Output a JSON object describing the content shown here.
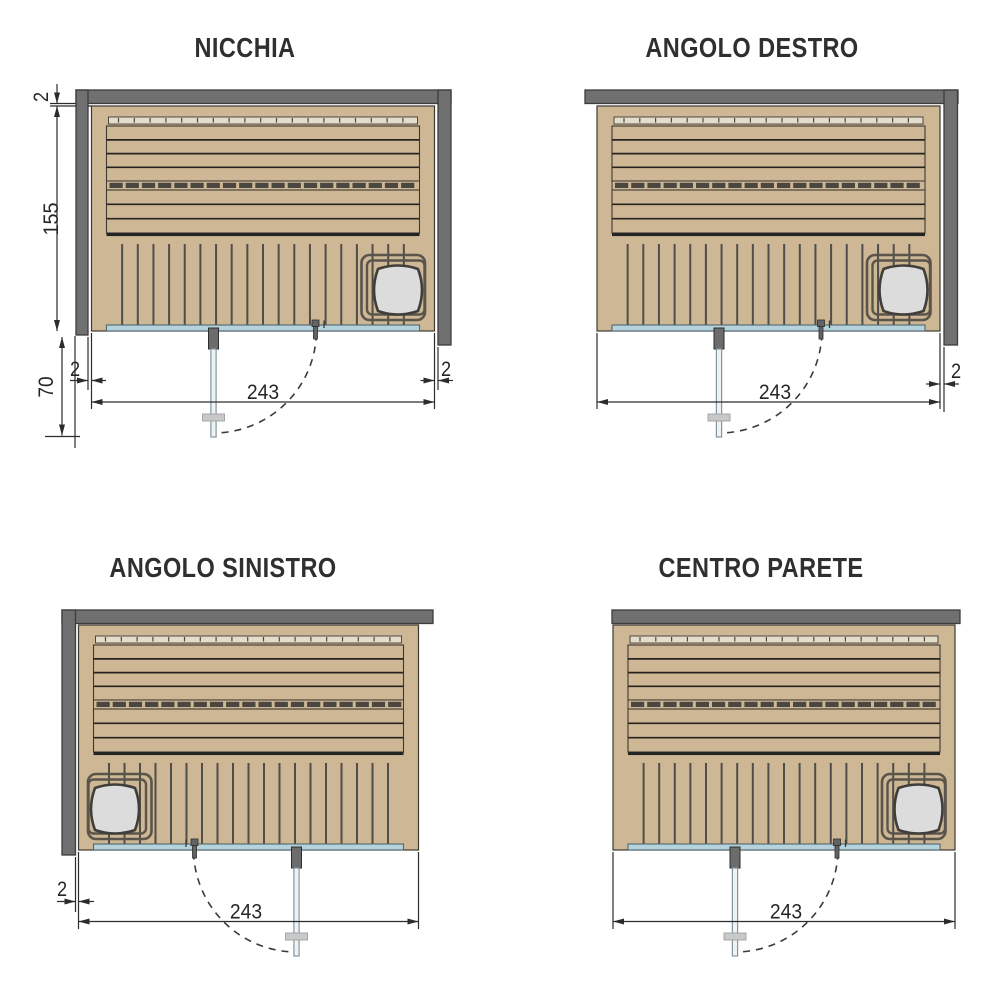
{
  "page": {
    "width": 1000,
    "height": 1000,
    "background": "#ffffff"
  },
  "colors": {
    "wood": "#cdb795",
    "wood_outline": "#3e3a32",
    "plank_gap": "#26241e",
    "backrest": "#e4ddcb",
    "segment": "#4b463f",
    "floor_gap": "#504e48",
    "glass": "#b5d3dd",
    "glass_edge": "#53666e",
    "wall": "#707070",
    "wall_edge": "#3d3d3d",
    "heater_frame": "#5a544b",
    "stove": "#dcdcdc",
    "stove_edge": "#403e3a",
    "door_glass": "#eef2f4",
    "door_edge": "#8296a0",
    "hinge": "#6c6c6c",
    "hinge_edge": "#2d2d2d",
    "handle": "#c9c9c9",
    "handle_edge": "#9f9f9f",
    "knob": "#636363",
    "dim_line": "#2c2c2c",
    "text": "#262626",
    "arc": "#3a3a3a"
  },
  "diagrams": [
    {
      "id": "nicchia",
      "title": "NICCHIA",
      "title_cx": 245,
      "title_top": 33,
      "sauna": {
        "x": 91.5,
        "y": 106,
        "w": 343,
        "h": 225,
        "heater": "right",
        "door": "left"
      },
      "walls": [
        {
          "name": "wall-top",
          "x": 76,
          "y": 90,
          "w": 375,
          "h": 13.5
        },
        {
          "name": "wall-left",
          "x": 76,
          "y": 90,
          "w": 12,
          "h": 245
        },
        {
          "name": "wall-right",
          "x": 438,
          "y": 90,
          "w": 13,
          "h": 255
        }
      ],
      "dims": [
        {
          "name": "dim-gap-top",
          "label": "2",
          "rotated": true,
          "label_pos": [
            48,
            97
          ],
          "lines": [
            [
              57,
              84,
              57,
              103.5
            ],
            [
              50,
              103.5,
              76,
              103.5
            ],
            [
              50,
              106,
              91.5,
              106
            ]
          ],
          "arrows": [
            {
              "tip": [
                57,
                103.5
              ],
              "dir": "down"
            }
          ]
        },
        {
          "name": "dim-depth",
          "label": "155",
          "rotated": true,
          "label_pos": [
            58,
            219
          ],
          "lines": [
            [
              57,
              106,
              57,
              331
            ]
          ],
          "arrows": [
            {
              "tip": [
                57,
                106
              ],
              "dir": "up"
            },
            {
              "tip": [
                57,
                331
              ],
              "dir": "down"
            }
          ]
        },
        {
          "name": "dim-clearance",
          "label": "70",
          "rotated": true,
          "label_pos": [
            53,
            387
          ],
          "lines": [
            [
              62,
              337,
              62,
              435.5
            ],
            [
              45,
              436.5,
              80,
              436.5
            ],
            [
              75,
              336,
              75,
              448
            ]
          ],
          "arrows": [
            {
              "tip": [
                62,
                337
              ],
              "dir": "up"
            },
            {
              "tip": [
                62,
                435.5
              ],
              "dir": "down"
            }
          ]
        },
        {
          "name": "dim-gap-left",
          "label": "2",
          "label_pos": [
            75,
            376
          ],
          "lines": [
            [
              88,
              337,
              88,
              390
            ],
            [
              70,
              380.5,
              88,
              380.5
            ],
            [
              91.5,
              380.5,
              106,
              380.5
            ]
          ],
          "arrows": [
            {
              "tip": [
                88,
                380.5
              ],
              "dir": "right"
            },
            {
              "tip": [
                91.5,
                380.5
              ],
              "dir": "left"
            }
          ]
        },
        {
          "name": "dim-gap-right",
          "label": "2",
          "label_pos": [
            446,
            376
          ],
          "lines": [
            [
              438,
              347,
              438,
              390
            ],
            [
              420.5,
              380.5,
              434.5,
              380.5
            ],
            [
              438,
              380.5,
              453,
              380.5
            ]
          ],
          "arrows": [
            {
              "tip": [
                434.5,
                380.5
              ],
              "dir": "right"
            },
            {
              "tip": [
                438,
                380.5
              ],
              "dir": "left"
            }
          ]
        },
        {
          "name": "dim-width",
          "label": "243",
          "label_pos": [
            263,
            399
          ],
          "lines": [
            [
              91.5,
              402,
              434.5,
              402
            ],
            [
              91.5,
              333,
              91.5,
              409
            ],
            [
              434.5,
              333,
              434.5,
              409
            ]
          ],
          "arrows": [
            {
              "tip": [
                91.5,
                402
              ],
              "dir": "left"
            },
            {
              "tip": [
                434.5,
                402
              ],
              "dir": "right"
            }
          ]
        }
      ]
    },
    {
      "id": "angolo-destro",
      "title": "ANGOLO DESTRO",
      "title_cx": 752,
      "title_top": 33,
      "sauna": {
        "x": 597,
        "y": 106,
        "w": 343,
        "h": 225,
        "heater": "right",
        "door": "left"
      },
      "walls": [
        {
          "name": "wall-top",
          "x": 585,
          "y": 90,
          "w": 373,
          "h": 13.5
        },
        {
          "name": "wall-right",
          "x": 944,
          "y": 90,
          "w": 13.5,
          "h": 255
        }
      ],
      "dims": [
        {
          "name": "dim-gap-right",
          "label": "2",
          "label_pos": [
            956,
            378
          ],
          "lines": [
            [
              944,
              347,
              944,
              412
            ],
            [
              926,
              384,
              940,
              384
            ],
            [
              944,
              384,
              959,
              384
            ]
          ],
          "arrows": [
            {
              "tip": [
                940,
                384
              ],
              "dir": "right"
            },
            {
              "tip": [
                944,
                384
              ],
              "dir": "left"
            }
          ]
        },
        {
          "name": "dim-width",
          "label": "243",
          "label_pos": [
            775,
            399
          ],
          "lines": [
            [
              597,
              402,
              940,
              402
            ],
            [
              597,
              333,
              597,
              409
            ],
            [
              940,
              333,
              940,
              409
            ]
          ],
          "arrows": [
            {
              "tip": [
                597,
                402
              ],
              "dir": "left"
            },
            {
              "tip": [
                940,
                402
              ],
              "dir": "right"
            }
          ]
        }
      ]
    },
    {
      "id": "angolo-sinistro",
      "title": "ANGOLO SINISTRO",
      "title_cx": 223,
      "title_top": 553,
      "sauna": {
        "x": 78.5,
        "y": 625,
        "w": 340,
        "h": 225,
        "heater": "left",
        "door": "right"
      },
      "walls": [
        {
          "name": "wall-top",
          "x": 62,
          "y": 610,
          "w": 371,
          "h": 13.5
        },
        {
          "name": "wall-left",
          "x": 62,
          "y": 610,
          "w": 13.5,
          "h": 245
        }
      ],
      "dims": [
        {
          "name": "dim-gap-left",
          "label": "2",
          "label_pos": [
            62,
            896
          ],
          "lines": [
            [
              75.5,
              857,
              75.5,
              912
            ],
            [
              57,
              901.5,
              75.5,
              901.5
            ],
            [
              78.5,
              901.5,
              94,
              901.5
            ]
          ],
          "arrows": [
            {
              "tip": [
                75.5,
                901.5
              ],
              "dir": "right"
            },
            {
              "tip": [
                78.5,
                901.5
              ],
              "dir": "left"
            }
          ]
        },
        {
          "name": "dim-width",
          "label": "243",
          "label_pos": [
            246,
            918.5
          ],
          "lines": [
            [
              78.5,
              921.5,
              418.5,
              921.5
            ],
            [
              78.5,
              852,
              78.5,
              929
            ],
            [
              418.5,
              852,
              418.5,
              929
            ]
          ],
          "arrows": [
            {
              "tip": [
                78.5,
                921.5
              ],
              "dir": "left"
            },
            {
              "tip": [
                418.5,
                921.5
              ],
              "dir": "right"
            }
          ]
        }
      ]
    },
    {
      "id": "centro-parete",
      "title": "CENTRO PARETE",
      "title_cx": 761,
      "title_top": 553,
      "sauna": {
        "x": 613,
        "y": 625,
        "w": 342,
        "h": 225,
        "heater": "right",
        "door": "left"
      },
      "walls": [
        {
          "name": "wall-top",
          "x": 612,
          "y": 610,
          "w": 348,
          "h": 13.5
        }
      ],
      "dims": [
        {
          "name": "dim-width",
          "label": "243",
          "label_pos": [
            786,
            918.5
          ],
          "lines": [
            [
              613,
              921.5,
              955,
              921.5
            ],
            [
              613,
              852,
              613,
              929
            ],
            [
              955,
              852,
              955,
              929
            ]
          ],
          "arrows": [
            {
              "tip": [
                613,
                921.5
              ],
              "dir": "left"
            },
            {
              "tip": [
                955,
                921.5
              ],
              "dir": "right"
            }
          ]
        }
      ]
    }
  ]
}
